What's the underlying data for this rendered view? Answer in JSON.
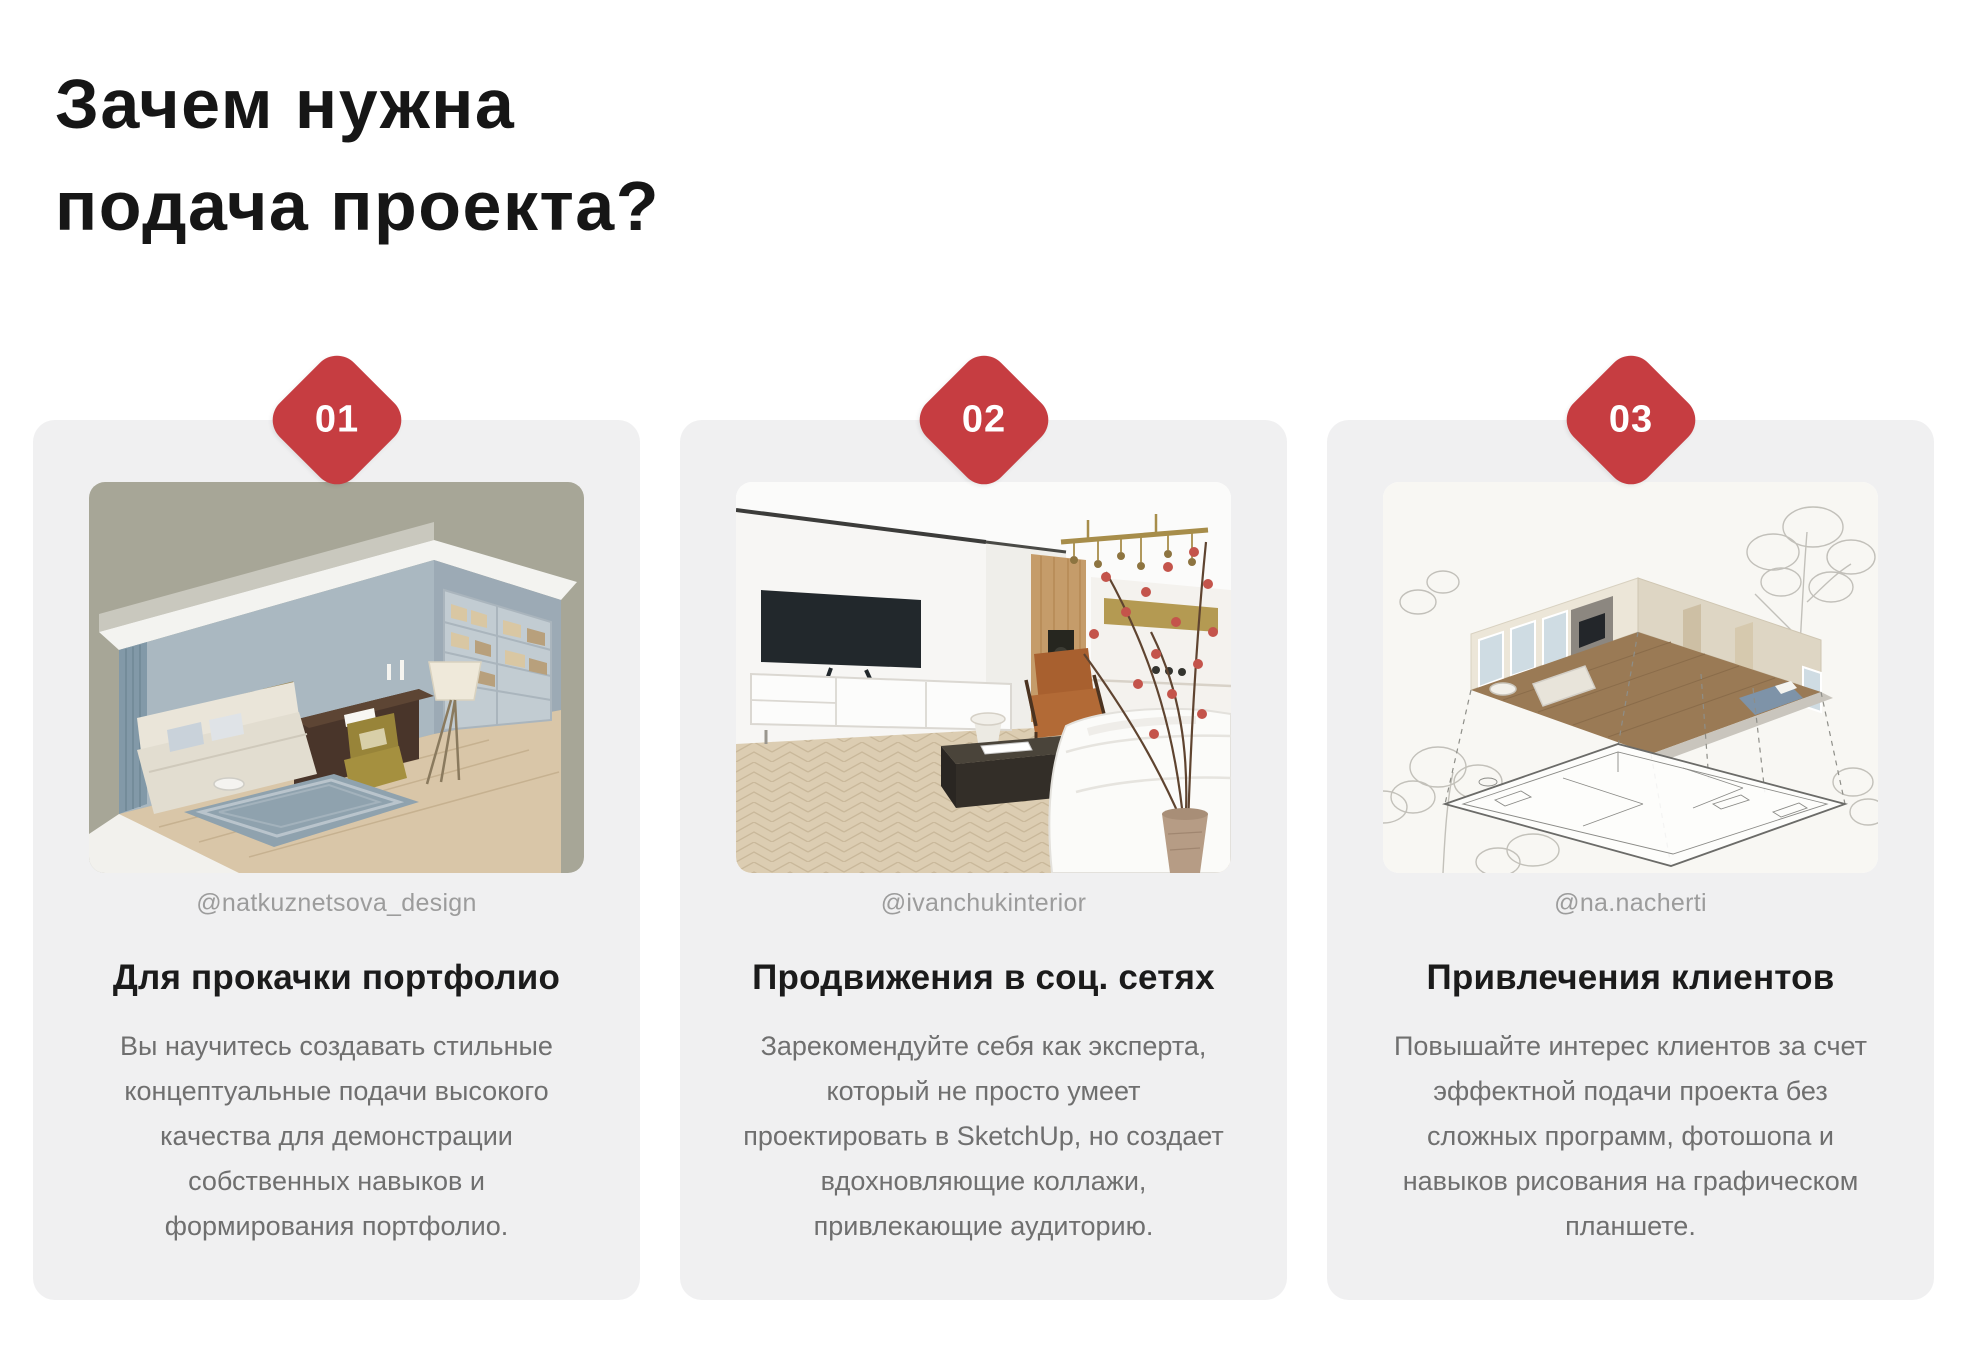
{
  "page": {
    "title_line1": "Зачем нужна",
    "title_line2": "подача проекта?"
  },
  "colors": {
    "accent_red": "#c63d41",
    "card_background": "#f0f0f1",
    "title_text": "#161616",
    "heading_text": "#1b1b1b",
    "body_text": "#6f6f6f",
    "caption_text": "#9c9c9c"
  },
  "cards": [
    {
      "badge": "01",
      "image_caption": "@natkuznetsova_design",
      "heading": "Для прокачки портфолио",
      "body": "Вы научитесь создавать стильные концептуальные подачи высокого качества для демонстрации собственных навыков и формирования портфолио."
    },
    {
      "badge": "02",
      "image_caption": "@ivanchukinterior",
      "heading": "Продвижения в соц. сетях",
      "body": "Зарекомендуйте себя как эксперта, который не просто умеет проектировать в SketchUp, но создает вдохновляющие коллажи, привлекающие аудиторию."
    },
    {
      "badge": "03",
      "image_caption": "@na.nacherti",
      "heading": "Привлечения клиентов",
      "body": "Повышайте интерес клиентов за счет эффектной подачи проекта без сложных программ, фотошопа и навыков рисования на графическом планшете."
    }
  ]
}
